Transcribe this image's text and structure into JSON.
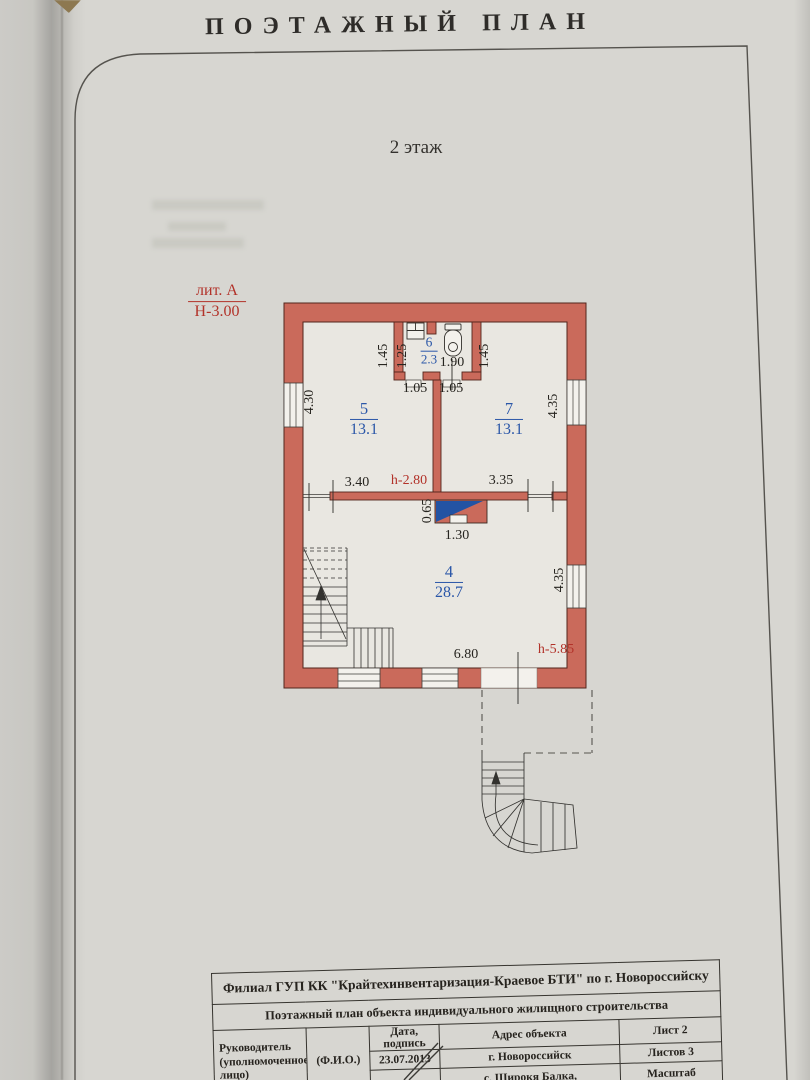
{
  "page": {
    "title": "ПОЭТАЖНЫЙ ПЛАН",
    "floor_label": "2 этаж"
  },
  "plan": {
    "liter_label": "лит. А",
    "building_height": "Н-3.00",
    "rooms": {
      "r4": {
        "number": "4",
        "area": "28.7"
      },
      "r5": {
        "number": "5",
        "area": "13.1"
      },
      "r6": {
        "number": "6",
        "area": "2.3"
      },
      "r7": {
        "number": "7",
        "area": "13.1"
      }
    },
    "dims": {
      "bath_left_outer": "1.45",
      "bath_left_inner": "1.25",
      "bath_toilet_width": "1.90",
      "bath_right_outer": "1.45",
      "bath_door_left": "1.05",
      "bath_door_right": "1.05",
      "left_wall": "4.30",
      "right_wall_top": "4.35",
      "room5_width": "3.40",
      "ceiling_height": "h-2.80",
      "room7_width": "3.35",
      "chimney_depth": "0.65",
      "chimney_width": "1.30",
      "room4_width": "6.80",
      "ridge_height": "h-5.85",
      "right_wall_bottom": "4.35"
    }
  },
  "title_block": {
    "org": "Филиал ГУП КК \"Крайтехинвентаризация-Краевое БТИ\" по г. Новороссийску",
    "doc_type": "Поэтажный план объекта индивидуального жилищного строительства",
    "leader": "Руководитель\n(уполномоченное\nлицо)",
    "fio": "(Ф.И.О.)",
    "date_header": "Дата, подпись",
    "date_value": "23.07.2013",
    "address_header": "Адрес объекта",
    "address_city": "г. Новороссийск",
    "address_village": "с. Широкя Балка,",
    "sheet": "Лист 2",
    "sheets_total": "Листов 3",
    "scale_label": "Масштаб"
  }
}
